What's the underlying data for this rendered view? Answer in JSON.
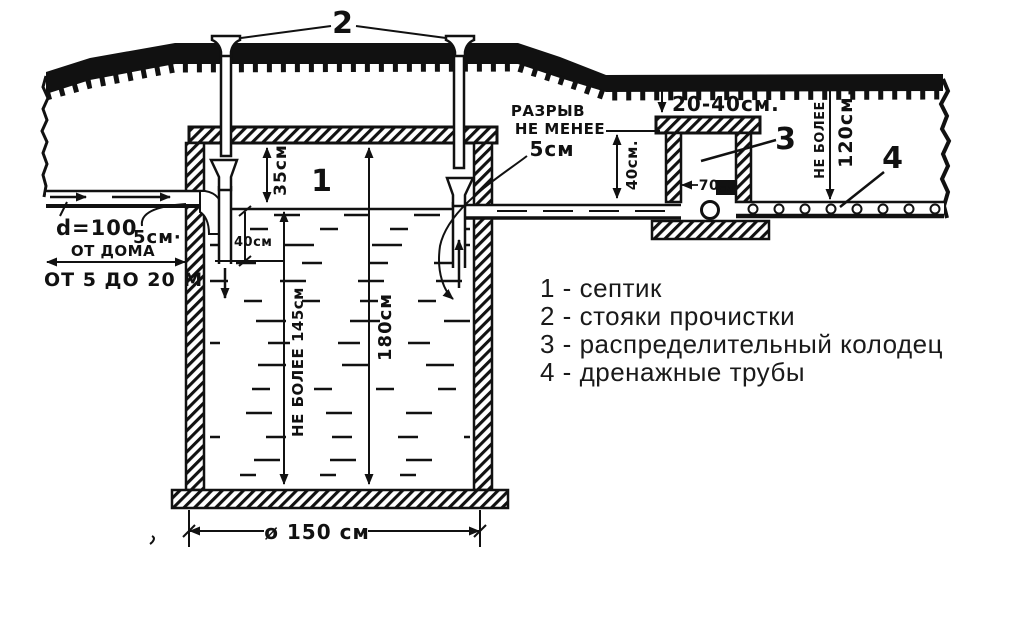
{
  "figure": {
    "kind": "septic-system-section-diagram",
    "colors": {
      "ink": "#111111",
      "paper": "#ffffff"
    }
  },
  "labels": {
    "callout_risers": "2",
    "callout_septic": "1",
    "callout_well": "3",
    "callout_drain": "4",
    "razryv_1": "РАЗРЫВ",
    "razryv_2": "НЕ МЕНЕЕ",
    "razryv_3": "5см",
    "pipe_diameter": "d=100",
    "drop_5cm": "5см·",
    "from_house": "ОТ ДОМА",
    "from_house_range": "ОТ 5 ДО 20 М",
    "dim_35": "35см",
    "dim_40_inlet": "40см",
    "dim_145": "НЕ БОЛЕЕ 145см",
    "dim_180": "180см",
    "dim_150": "ø 150 см",
    "dim_20_40": "20-40см.",
    "dim_40_well": "40см.",
    "dim_70": "70",
    "dim_70_unit": "см",
    "dim_120_prefix": "НЕ БОЛЕЕ",
    "dim_120": "120см."
  },
  "legend": {
    "items": [
      "1 - септик",
      "2 - стояки прочистки",
      "3 - распределительный колодец",
      "4 - дренажные трубы"
    ]
  }
}
